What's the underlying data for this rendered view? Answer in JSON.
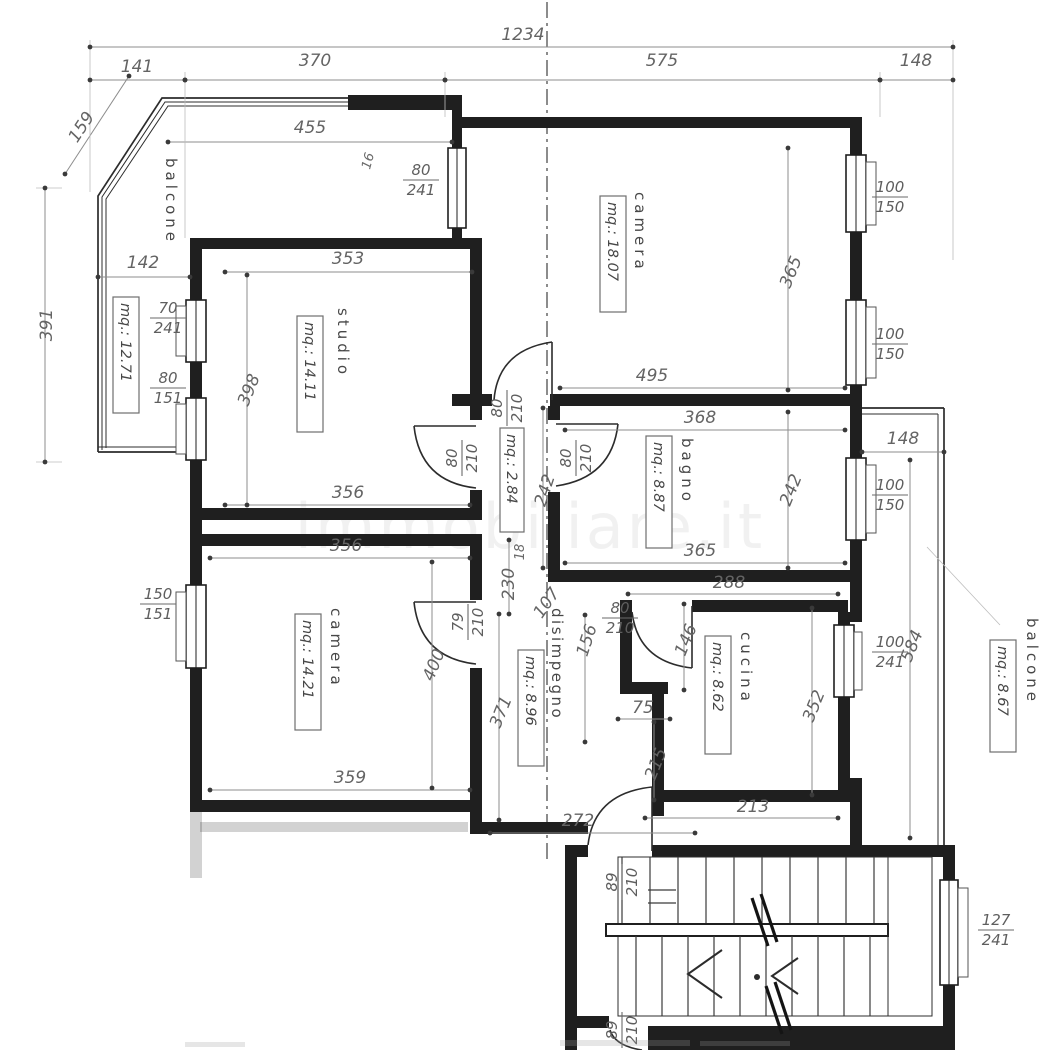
{
  "watermark": "immobiliare.it",
  "overall_dims": {
    "total_width": "1234",
    "top_segments": [
      "141",
      "370",
      "575",
      "148"
    ],
    "left_height": "391",
    "diagonal": "159",
    "balcony_top_width": "455",
    "balcony_bottom_width": "142",
    "small_pier": "16"
  },
  "rooms": {
    "balcone_left": {
      "name": "balcone",
      "mq": "mq.: 12.71"
    },
    "studio": {
      "name": "studio",
      "mq": "mq.: 14.11",
      "width_top": "353",
      "width_bottom": "356",
      "height": "398"
    },
    "camera_top": {
      "name": "camera",
      "mq": "mq.: 18.07",
      "width_bottom": "495",
      "height": "365"
    },
    "bagno": {
      "name": "bagno",
      "mq": "mq.: 8.87",
      "width_top": "368",
      "width_bottom": "365",
      "height": "242"
    },
    "corridoio": {
      "mq": "mq.: 2.84",
      "height": "242",
      "dim_230": "230",
      "dim_107": "107",
      "dim_18": "18"
    },
    "camera_left": {
      "name": "camera",
      "mq": "mq.: 14.21",
      "width_top": "356",
      "width_bottom": "359",
      "height": "400"
    },
    "disimpegno": {
      "name": "disimpegno",
      "mq": "mq.: 8.96",
      "height": "371",
      "width_bottom": "272",
      "dim_156": "156"
    },
    "cucina": {
      "name": "cucina",
      "mq": "mq.: 8.62",
      "width_top": "288",
      "width_bottom": "213",
      "height": "352",
      "dim_146": "146",
      "dim_75": "75",
      "dim_215": "215"
    },
    "balcone_right": {
      "name": "balcone",
      "mq": "mq.: 8.67",
      "width_top": "148",
      "height": "584"
    }
  },
  "openings": {
    "door_80_241": {
      "w": "80",
      "h": "241"
    },
    "window_70_241": {
      "w": "70",
      "h": "241"
    },
    "window_80_151": {
      "w": "80",
      "h": "151"
    },
    "window_100_150": {
      "w": "100",
      "h": "150"
    },
    "window_150_151": {
      "w": "150",
      "h": "151"
    },
    "window_100_241": {
      "w": "100",
      "h": "241"
    },
    "door_80_210": {
      "w": "80",
      "h": "210"
    },
    "door_79_210": {
      "w": "79",
      "h": "210"
    },
    "door_89_210": {
      "w": "89",
      "h": "210"
    },
    "window_127_241": {
      "w": "127",
      "h": "241"
    }
  }
}
